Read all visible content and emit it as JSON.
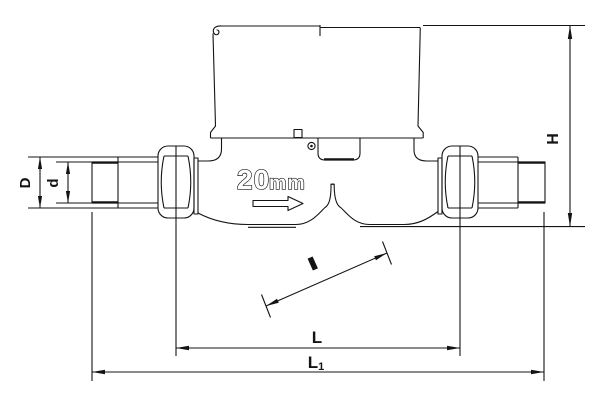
{
  "page": {
    "background": "#ffffff",
    "line_color": "#141414"
  },
  "drawing": {
    "description": "Dimensioned outline drawing of a water meter, front elevation",
    "meter_marking": {
      "value": "20",
      "unit": "mm"
    },
    "dimension_labels": {
      "pipe_outer_diameter": "D",
      "bore_diameter": "d",
      "overall_height": "H",
      "body_length": "L",
      "overall_length_base": "L",
      "overall_length_subscript": "1"
    }
  }
}
